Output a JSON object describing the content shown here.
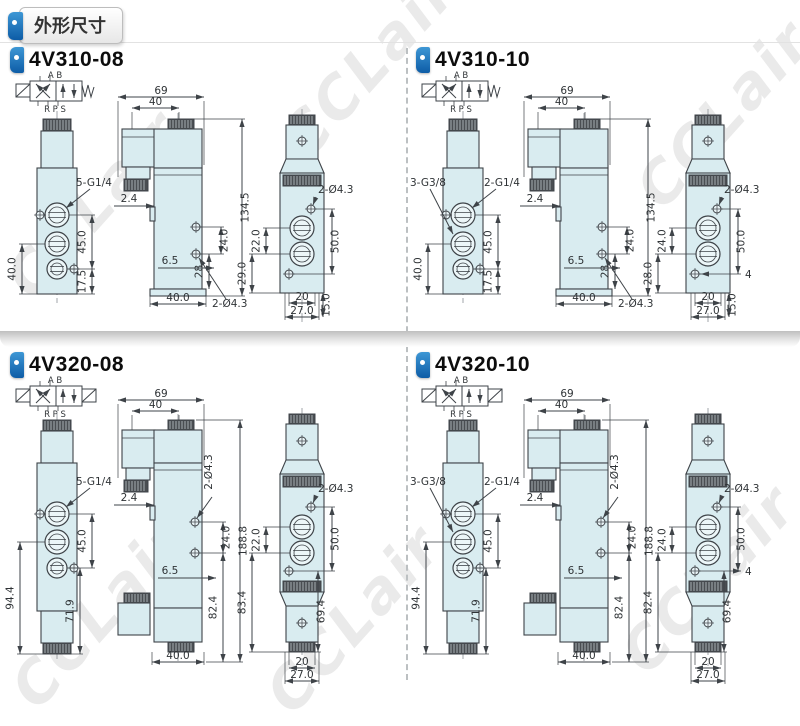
{
  "header": {
    "title": "外形尺寸"
  },
  "watermark": {
    "text": "CCLair"
  },
  "colors": {
    "accent_blue": "#1673bc",
    "body_fill": "#d9ecf0",
    "line": "#3e4348"
  },
  "sections": [
    {
      "model": "4V310-08",
      "type": "single",
      "schematic": {
        "top_label": "A B",
        "bottom_label": "R P S"
      },
      "front": {
        "port_label_left": "",
        "port_label_right": "5-G1/4",
        "dim_left": "40.0",
        "dim_right_upper": "45.0",
        "dim_right_lower": "17.5"
      },
      "side": {
        "dim_top_outer": "69",
        "dim_top_inner": "40",
        "dim_offset": "2.4",
        "dim_height": "134.5",
        "dim_hole_pitch": "24.0",
        "dim_hole_lower": "28",
        "dim_inset": "6.5",
        "dim_base": "40.0",
        "label_holes": "2-Ø4.3"
      },
      "back": {
        "label_holes": "2-Ø4.3",
        "dim_left_upper": "22.0",
        "dim_left_lower": "29.0",
        "dim_right_upper": "50.0",
        "dim_right_lower": "15.0",
        "dim_extra": "",
        "dim_base_inner": "20",
        "dim_base_outer": "27.0"
      }
    },
    {
      "model": "4V310-10",
      "type": "single",
      "schematic": {
        "top_label": "A B",
        "bottom_label": "R P S"
      },
      "front": {
        "port_label_left": "3-G3/8",
        "port_label_right": "2-G1/4",
        "dim_left": "40.0",
        "dim_right_upper": "45.0",
        "dim_right_lower": "17.5"
      },
      "side": {
        "dim_top_outer": "69",
        "dim_top_inner": "40",
        "dim_offset": "2.4",
        "dim_height": "134.5",
        "dim_hole_pitch": "24.0",
        "dim_hole_lower": "28",
        "dim_inset": "6.5",
        "dim_base": "40.0",
        "label_holes": "2-Ø4.3"
      },
      "back": {
        "label_holes": "2-Ø4.3",
        "dim_left_upper": "24.0",
        "dim_left_lower": "28.0",
        "dim_right_upper": "50.0",
        "dim_right_lower": "15.0",
        "dim_extra": "4",
        "dim_base_inner": "20",
        "dim_base_outer": "27.0"
      }
    },
    {
      "model": "4V320-08",
      "type": "double",
      "schematic": {
        "top_label": "A B",
        "bottom_label": "R P S"
      },
      "front": {
        "port_label_left": "",
        "port_label_right": "5-G1/4",
        "dim_left": "94.4",
        "dim_right_upper": "45.0",
        "dim_right_lower": "71.9"
      },
      "side": {
        "dim_top_outer": "69",
        "dim_top_inner": "40",
        "dim_offset": "2.4",
        "dim_height": "188.8",
        "dim_hole_pitch": "24.0",
        "dim_hole_lower": "82.4",
        "dim_inset": "6.5",
        "dim_base": "40.0",
        "label_holes": "2-Ø4.3"
      },
      "back": {
        "label_holes": "2-Ø4.3",
        "dim_left_upper": "22.0",
        "dim_left_lower": "83.4",
        "dim_right_upper": "50.0",
        "dim_right_lower": "69.4",
        "dim_extra": "",
        "dim_base_inner": "20",
        "dim_base_outer": "27.0"
      }
    },
    {
      "model": "4V320-10",
      "type": "double",
      "schematic": {
        "top_label": "A B",
        "bottom_label": "R P S"
      },
      "front": {
        "port_label_left": "3-G3/8",
        "port_label_right": "2-G1/4",
        "dim_left": "94.4",
        "dim_right_upper": "45.0",
        "dim_right_lower": "71.9"
      },
      "side": {
        "dim_top_outer": "69",
        "dim_top_inner": "40",
        "dim_offset": "2.4",
        "dim_height": "188.8",
        "dim_hole_pitch": "24.0",
        "dim_hole_lower": "82.4",
        "dim_inset": "6.5",
        "dim_base": "40.0",
        "label_holes": "2-Ø4.3"
      },
      "back": {
        "label_holes": "2-Ø4.3",
        "dim_left_upper": "24.0",
        "dim_left_lower": "82.4",
        "dim_right_upper": "50.0",
        "dim_right_lower": "69.4",
        "dim_extra": "4",
        "dim_base_inner": "20",
        "dim_base_outer": "27.0"
      }
    }
  ]
}
